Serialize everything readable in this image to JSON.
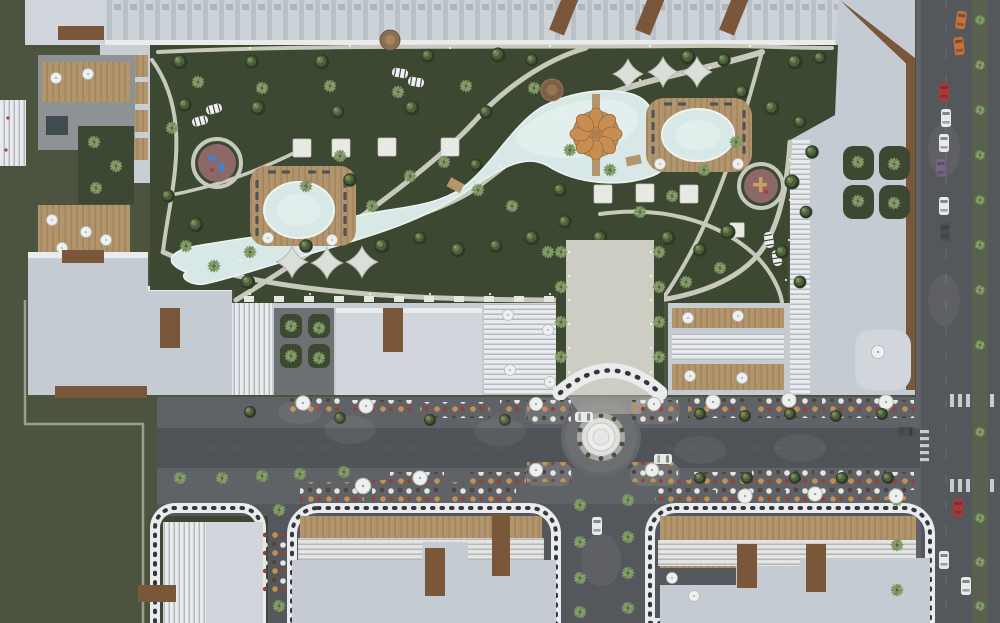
{
  "meta": {
    "title": "Aerial dusk render of a residential compound masterplan",
    "type": "architectural-visualization",
    "view": "top-down"
  },
  "palette": {
    "grass": "#4c5440",
    "lawn": "#3c4831",
    "path": "#c6c9bb",
    "promenade": "#cecdc4",
    "pool": "#d7e8e6",
    "poolLight": "#e7f2f0",
    "poolDark": "#3f4b4f",
    "deck": "#b4966e",
    "wood": "#a5875f",
    "umbOrange": "#c88d50",
    "playground": "#8c6868",
    "roof": "#c4cbd2",
    "roofLight": "#d0d6db",
    "band": "#e9ebed",
    "brown": "#7a563a",
    "road": "#54575b",
    "roadLane": "#505357",
    "sidewalk": "#5f6266",
    "plaza": "#6f7274",
    "white": "#edeeee",
    "dotDark": "#34373c",
    "treeDark": "#2e3a26",
    "treeMid": "#4c5e3c",
    "treeLight": "#6d8354",
    "palm": "#7d9663",
    "median": "#59604e",
    "carWhite": "#e8e9e9",
    "carRed": "#ad3833",
    "carOrange": "#c3713a",
    "carPurple": "#6f5b80",
    "carDark": "#4a4d52",
    "cafeRed": "#9c3d36",
    "cafeTan": "#c2914f",
    "cafeWhite": "#e7e5e0",
    "cafeDark": "#55403c"
  },
  "scene": {
    "labels": {
      "render": "Aerial dusk render of a residential compound",
      "grass_field": "Lawn field",
      "main_complex": "Perimeter apartment block",
      "courtyard": "Landscaped courtyard park",
      "lagoon": "Freeform lagoon pool",
      "round_deck": "Circular cabana deck with parasols",
      "oval_pool_west": "West oval pool on timber deck",
      "oval_pool_east": "East oval pool on timber deck",
      "playground_west": "West playground",
      "playground_east": "East playground",
      "shade_sails": "Shade sails",
      "promenade": "Central entrance promenade",
      "entrance_canopy": "Perforated entrance canopy",
      "roundabout": "Roundabout with fountain rings",
      "boulevard": "East-west boulevard",
      "avenue": "North-south avenue with palm median",
      "bottom_blocks": "South residential blocks",
      "cafes": "Street cafe terraces",
      "cars": "Cars",
      "trees": "Trees and palms"
    },
    "counts": {
      "pools": 3,
      "playgrounds": 2,
      "shade_sails": 6,
      "roundabouts": 1,
      "cars": 15
    }
  }
}
